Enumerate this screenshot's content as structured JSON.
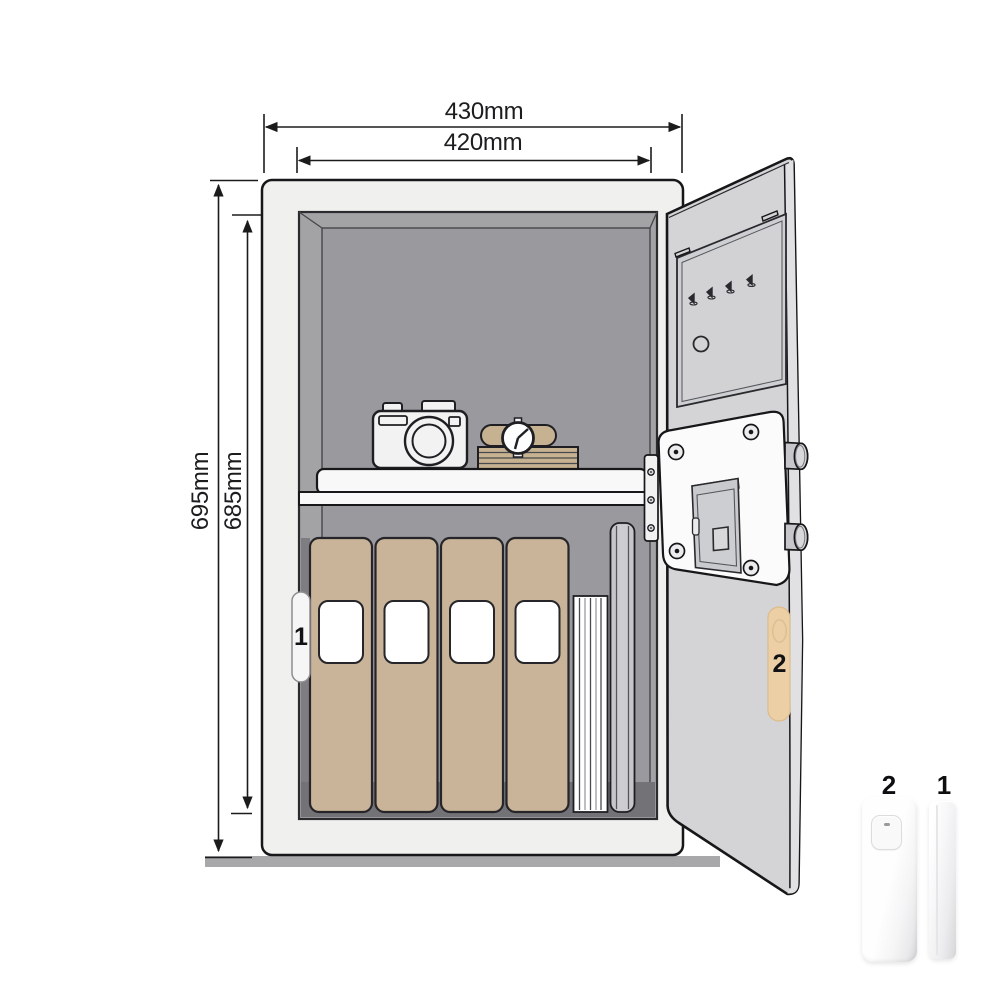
{
  "diagram": {
    "dimensions": {
      "outer_width": "430mm",
      "inner_width": "420mm",
      "outer_height": "695mm",
      "inner_height": "685mm"
    },
    "markers": {
      "interior_sensor": "1",
      "door_sensor": "2"
    },
    "products": {
      "main_sensor": "2",
      "magnet_sensor": "1"
    },
    "colors": {
      "line": "#1b1b1b",
      "safe_frame": "#f0f0ef",
      "interior_frame": "#a3a3a6",
      "interior_wall": "#9a9a9e",
      "interior_shadow": "#737377",
      "door": "#d4d4d6",
      "door_edge": "#e1e1e3",
      "binder_tan": "#cab499",
      "accessory_tan": "#eccfa5",
      "lock_housing": "#fbfbfc",
      "floor": "#a8a8aa"
    }
  }
}
